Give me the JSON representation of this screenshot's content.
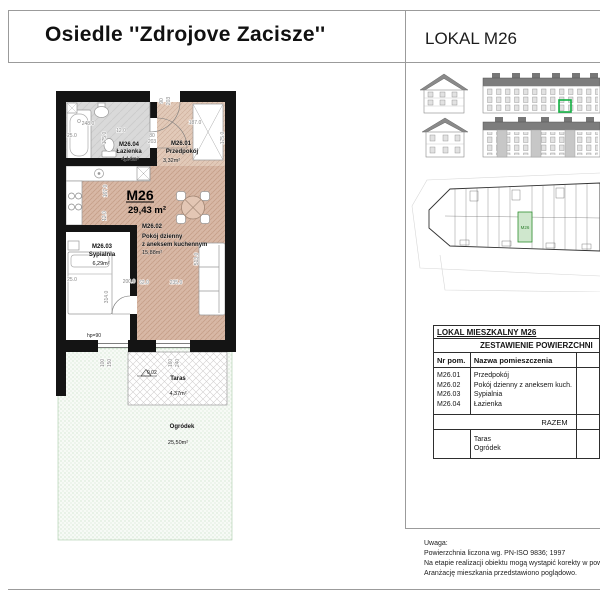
{
  "header": {
    "title": "Osiedle ''Zdrojove Zacisze''",
    "unit_label": "LOKAL M26"
  },
  "plan": {
    "unit_id": "M26",
    "total_area": "29,43 m²",
    "rooms": {
      "hall_id": "M26.01",
      "hall_name": "Przedpokój",
      "hall_area": "3,32m²",
      "living_id": "M26.02",
      "living_name_1": "Pokój dzienny",
      "living_name_2": "z aneksem kuchennym",
      "living_area": "15,88m²",
      "bed_id": "M26.03",
      "bed_name": "Sypialnia",
      "bed_area": "6,29m²",
      "bath_id": "M26.04",
      "bath_name": "Łazienka",
      "bath_area": "4,14m²"
    },
    "taras_name": "Taras",
    "taras_area": "4,37m²",
    "garden_name": "Ogródek",
    "garden_area": "25,50m²",
    "sill_label": "hp=90",
    "level_label": "0,02",
    "dims": {
      "d1": "25.0",
      "d2": "248.0",
      "d3": "175.0",
      "d4": "12.0",
      "d5": "80",
      "d6": "203",
      "d7": "90",
      "d8": "203",
      "d9": "187.0",
      "d10": "175.0",
      "d11": "167.0",
      "d12": "12.0",
      "d13": "62.0",
      "d14": "235.0",
      "d15": "513.0",
      "d16": "200.0",
      "d17": "314.0",
      "d18": "25.0",
      "d19": "100",
      "d20": "150",
      "d21": "160",
      "d22": "240"
    }
  },
  "site_plan": {
    "unit_label": "M26"
  },
  "table": {
    "title": "LOKAL MIESZKALNY M26",
    "subtitle": "ZESTAWIENIE POWIERZCHNI",
    "col_nr": "Nr pom.",
    "col_name": "Nazwa pomieszczenia",
    "rows": [
      {
        "nr": "M26.01",
        "name": "Przedpokój"
      },
      {
        "nr": "M26.02",
        "name": "Pokój dzienny z aneksem kuch."
      },
      {
        "nr": "M26.03",
        "name": "Sypialnia"
      },
      {
        "nr": "M26.04",
        "name": "Łazienka"
      }
    ],
    "sum_label": "RAZEM",
    "extra_rows": {
      "r1": "Taras",
      "r2": "Ogródek"
    }
  },
  "notes": {
    "line1": "Uwaga:",
    "line2": "Powierzchnia liczona wg. PN-ISO 9836; 1997",
    "line3": "Na etapie realizacji obiektu mogą wystąpić korekty w pow.",
    "line4": "Aranżację mieszkania przedstawiono poglądowo."
  }
}
